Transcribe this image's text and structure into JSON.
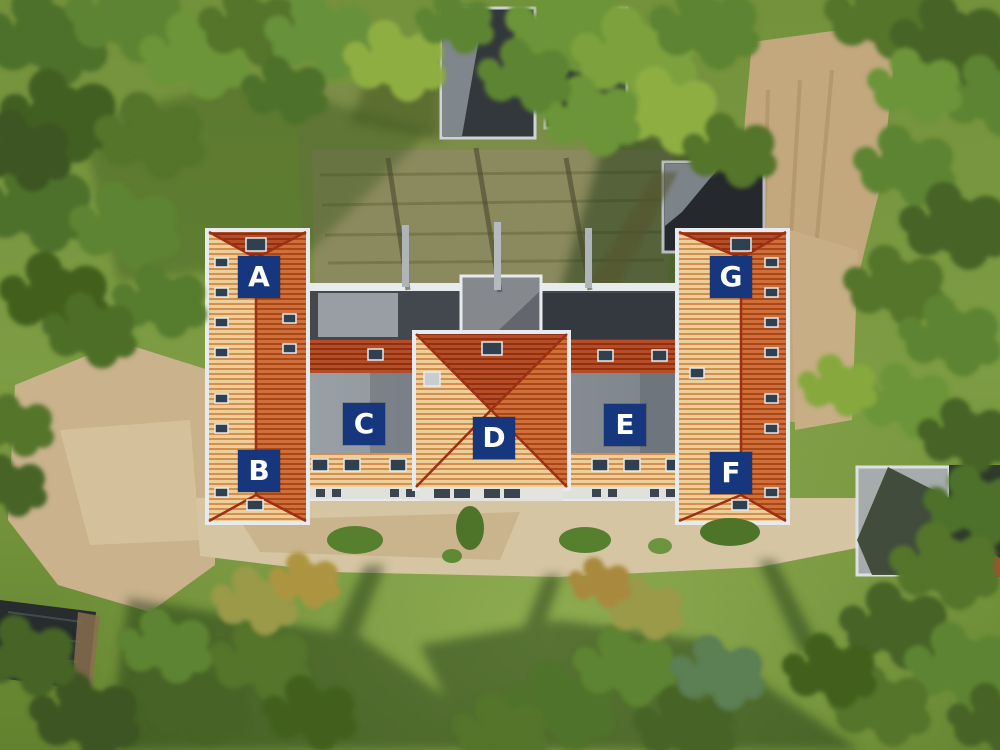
{
  "photo": {
    "description": "Aerial drone view of a residential apartment building with orange tiled roofs, surrounded by trees, lawn and sandy ground; seven unit sections are tagged with letter markers",
    "markers_title": "unit markers"
  },
  "markers": [
    {
      "letter": "A"
    },
    {
      "letter": "B"
    },
    {
      "letter": "C"
    },
    {
      "letter": "D"
    },
    {
      "letter": "E"
    },
    {
      "letter": "F"
    },
    {
      "letter": "G"
    }
  ],
  "marker_style": {
    "background": "#16377d",
    "text_color": "#ffffff"
  }
}
